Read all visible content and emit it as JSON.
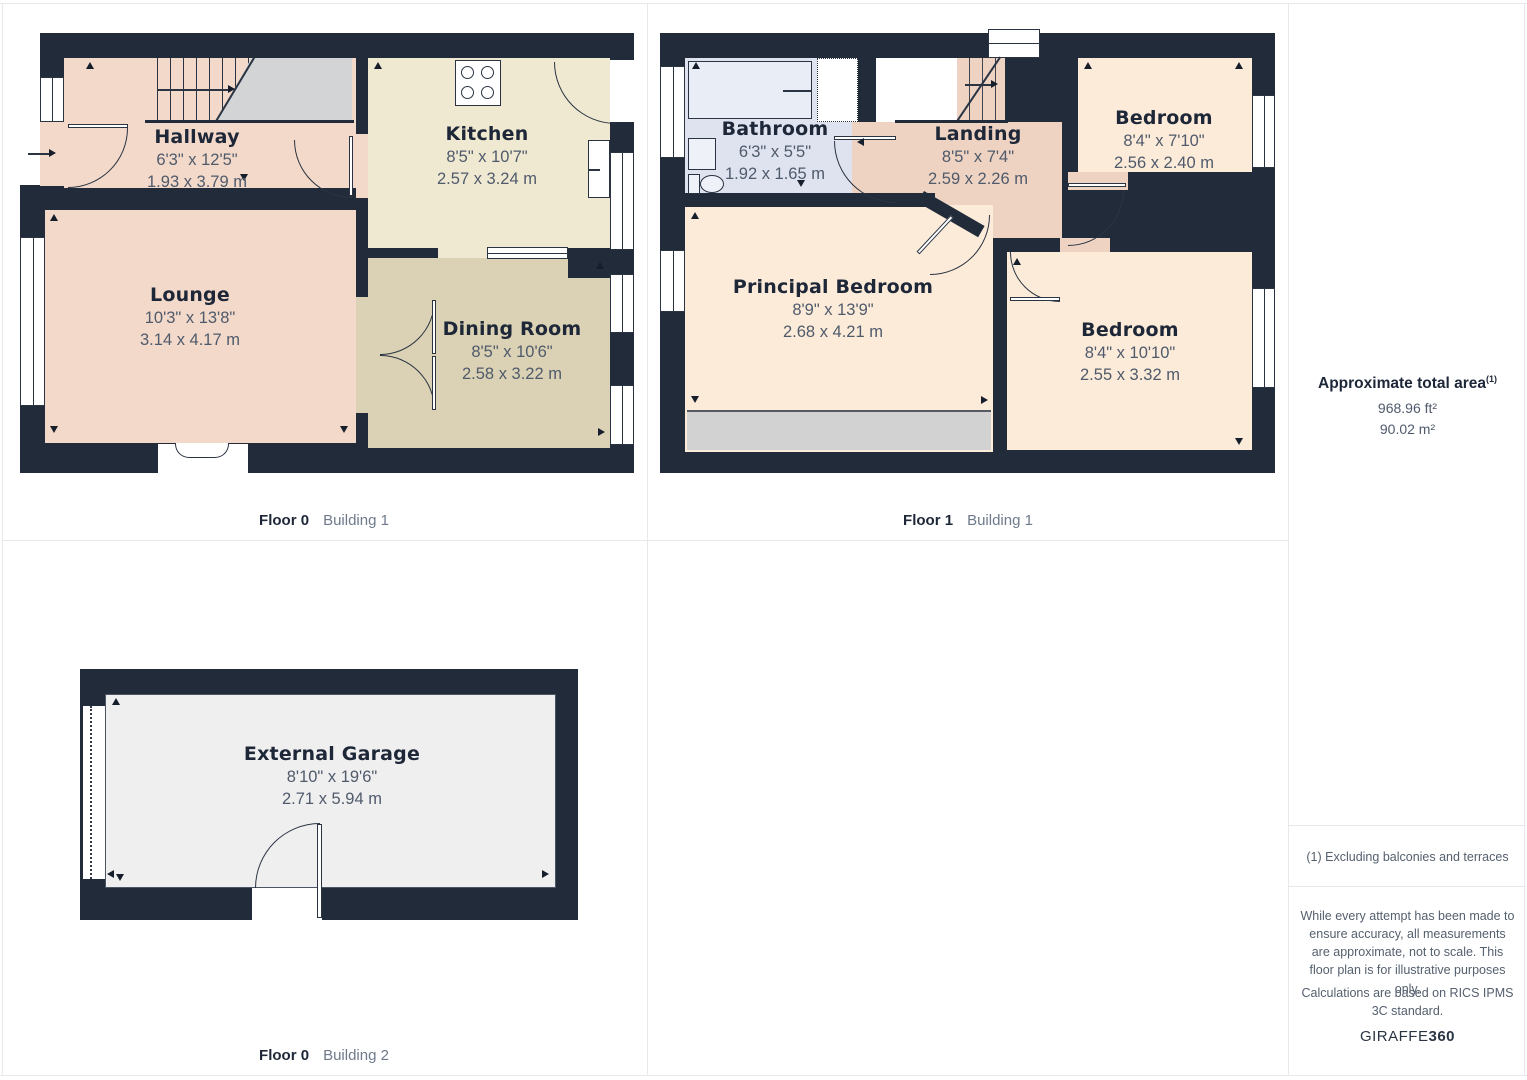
{
  "panels": [
    {
      "floor_label": "Floor 0",
      "building_label": "Building 1",
      "rooms": [
        {
          "name": "Hallway",
          "imperial": "6'3\" x 12'5\"",
          "metric": "1.93 x 3.79 m"
        },
        {
          "name": "Kitchen",
          "imperial": "8'5\" x 10'7\"",
          "metric": "2.57 x 3.24 m"
        },
        {
          "name": "Lounge",
          "imperial": "10'3\" x 13'8\"",
          "metric": "3.14 x 4.17 m"
        },
        {
          "name": "Dining Room",
          "imperial": "8'5\" x 10'6\"",
          "metric": "2.58 x 3.22 m"
        }
      ]
    },
    {
      "floor_label": "Floor 1",
      "building_label": "Building 1",
      "rooms": [
        {
          "name": "Bathroom",
          "imperial": "6'3\" x 5'5\"",
          "metric": "1.92 x 1.65 m"
        },
        {
          "name": "Landing",
          "imperial": "8'5\" x 7'4\"",
          "metric": "2.59 x 2.26 m"
        },
        {
          "name": "Bedroom",
          "imperial": "8'4\" x 7'10\"",
          "metric": "2.56 x 2.40 m"
        },
        {
          "name": "Principal Bedroom",
          "imperial": "8'9\" x 13'9\"",
          "metric": "2.68 x 4.21 m"
        },
        {
          "name": "Bedroom",
          "imperial": "8'4\" x 10'10\"",
          "metric": "2.55 x 3.32 m"
        }
      ]
    },
    {
      "floor_label": "Floor 0",
      "building_label": "Building 2",
      "rooms": [
        {
          "name": "External Garage",
          "imperial": "8'10\" x 19'6\"",
          "metric": "2.71 x 5.94 m"
        }
      ]
    }
  ],
  "sidebar": {
    "title": "Approximate total area",
    "title_superscript": "(1)",
    "area_ft": "968.96 ft²",
    "area_m": "90.02 m²",
    "footnote": "(1) Excluding balconies and terraces",
    "disclaimer_1": "While every attempt has been made to ensure accuracy, all measurements are approximate, not to scale. This floor plan is for illustrative purposes only.",
    "disclaimer_2": "Calculations are based on RICS IPMS 3C standard.",
    "brand_name": "GIRAFFE",
    "brand_suffix": "360"
  },
  "colors": {
    "wall": "#222b3a",
    "hallway_lounge": "#f3d9c9",
    "kitchen": "#f0e9d2",
    "dining": "#dbd2b5",
    "bathroom": "#dee3ef",
    "bedroom": "#fcebd9",
    "landing": "#eed3c2",
    "garage": "#f0eff0",
    "stair_gray": "#d3d4d6",
    "text_dark": "#1d2738",
    "text_dim": "#4f5a6b"
  }
}
